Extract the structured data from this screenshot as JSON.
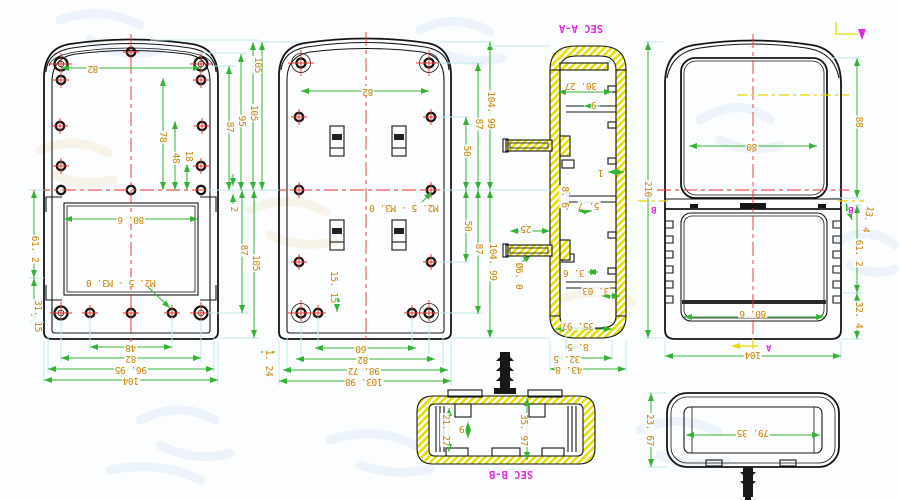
{
  "drawing": {
    "type": "multi-view CAD drawing of plastic enclosure shells with sections",
    "colors": {
      "outline": "#151515",
      "dimension_line": "#33b233",
      "extension_line": "#bfe9e9",
      "dimension_text": "#c8860a",
      "centerline": "#e63122",
      "section_hatch": "#e8df00",
      "section_label": "#e429e4"
    }
  },
  "marks": {
    "cut_a": "A",
    "cut_b": "B"
  },
  "view1": {
    "w82": "82",
    "h87_top": "87",
    "h95": "95",
    "h105_top": "105",
    "v78": "78",
    "v48": "48",
    "v18": "18",
    "gap2": "2",
    "w80_6": "80. 6",
    "h87_bot": "87",
    "h105_bot": "105",
    "left61_2": "61. 2",
    "left31_15": "31. 15",
    "thread_note": "M2. 5 - M3. 0",
    "b48": "48",
    "b82": "82",
    "b96_95": "96. 95",
    "b104": "104",
    "gap1_24": "1. 24"
  },
  "view2": {
    "h105": "105",
    "w82": "82",
    "r104_99_top": "104. 99",
    "r87_top": "87",
    "r50_top": "50",
    "r50_bot": "50",
    "r87_bot": "87",
    "r104_99_bot": "104. 99",
    "v15_15": "15. 15",
    "thread_note": "M2. 5 - M3. 0",
    "pin25": "25",
    "pin_dia": "Ø6. 0",
    "b60": "60",
    "b82": "82",
    "b98_72": "98. 72",
    "b103_98": "103. 98"
  },
  "sec_aa": {
    "title": "SEC A-A",
    "d30_27": "30. 27",
    "d9": "9",
    "d1": "1",
    "d8_6": "8. 6",
    "d5_7": "5. 7",
    "d3_6": "3. 6",
    "d3_03": "3. 03",
    "d35_97": "35. 97",
    "b8_5": "8. 5",
    "b32_5": "32. 5",
    "b43_8": "43. 8"
  },
  "view4": {
    "h210": "210",
    "h88": "88",
    "w80": "80",
    "d13_4": "13. 4",
    "h61_2": "61. 2",
    "h32_4": "32. 4",
    "w80_6": "80. 6",
    "b104": "104"
  },
  "sec_bb": {
    "title": "SEC B-B",
    "d21_27": "21. 27",
    "d9": "9",
    "d35_97": "35. 97"
  },
  "view6": {
    "h23_67": "23. 67",
    "w79_35": "79. 35"
  }
}
